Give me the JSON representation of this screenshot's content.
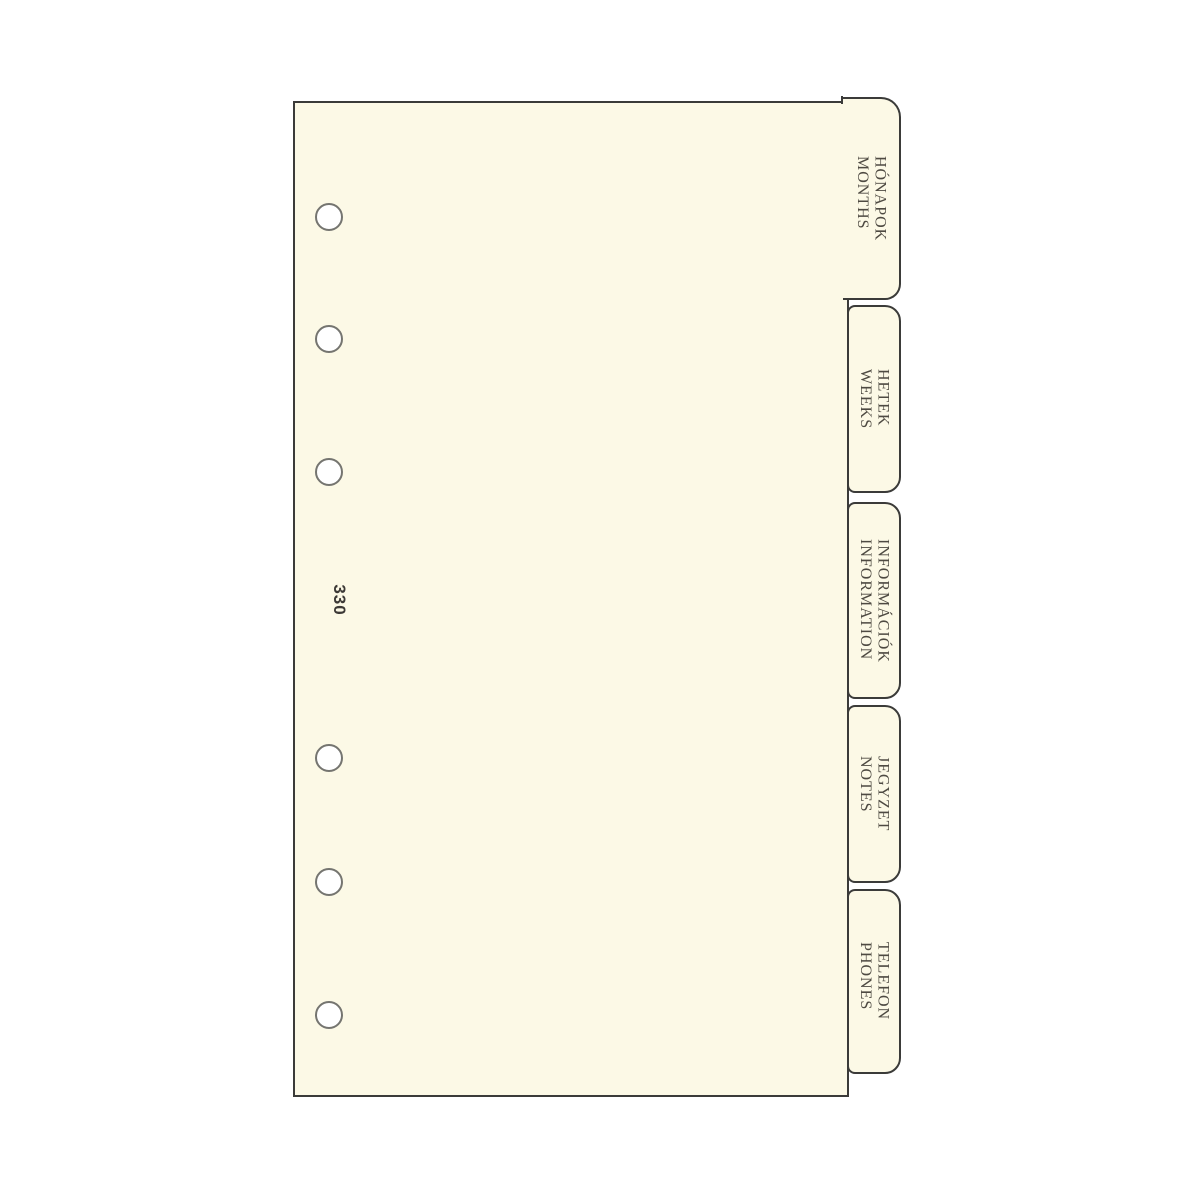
{
  "product": {
    "item_number": "330",
    "type_description": "planner divider set with index tabs"
  },
  "tabs": [
    {
      "hu": "HÓNAPOK",
      "en": "MONTHS"
    },
    {
      "hu": "HETEK",
      "en": "WEEKS"
    },
    {
      "hu": "INFORMÁCIÓK",
      "en": "INFORMATION"
    },
    {
      "hu": "JEGYZET",
      "en": "NOTES"
    },
    {
      "hu": "TELEFON",
      "en": "PHONES"
    }
  ],
  "colors": {
    "background": "#FFFFFF",
    "sheet_fill": "#FCF9E6",
    "outline": "#3B3B39",
    "tab_text": "#4E4A42",
    "hole_ring": "#757570",
    "item_number_text": "#3C3936"
  }
}
